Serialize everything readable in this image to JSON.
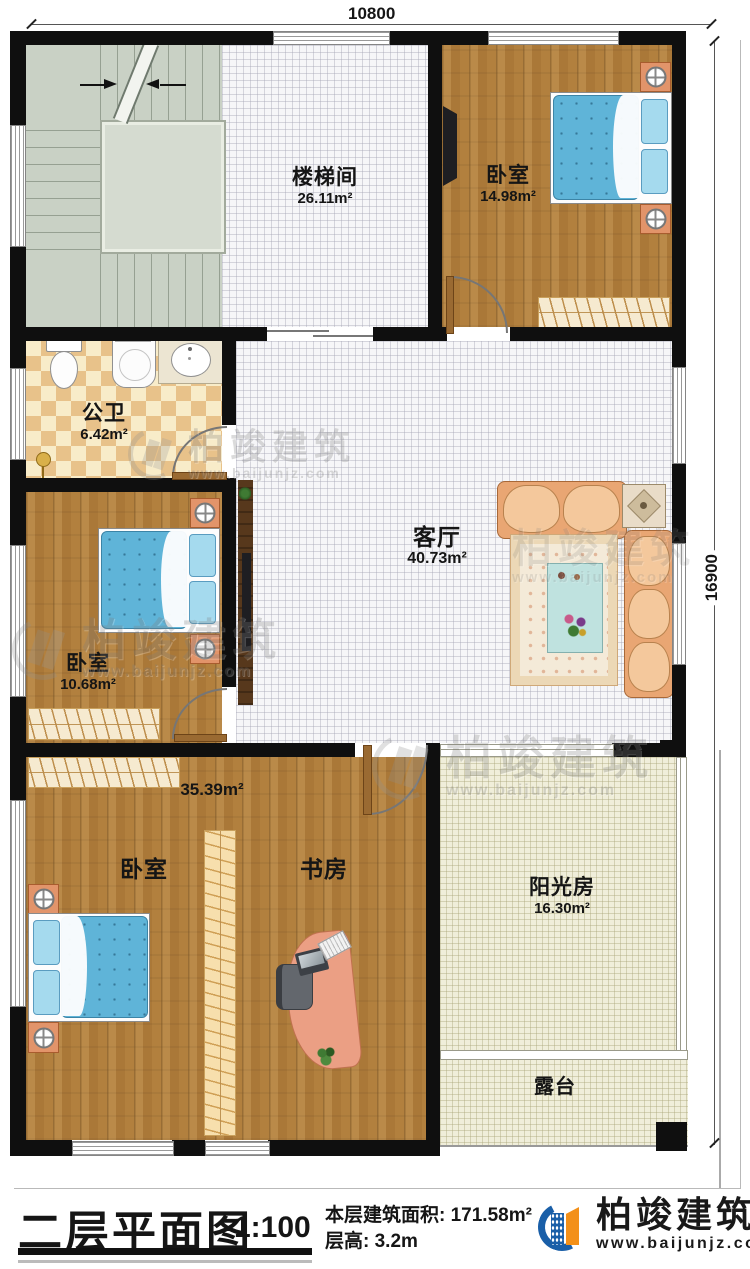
{
  "page": {
    "dimensions": {
      "top": "10800",
      "right": "16900"
    }
  },
  "watermark": {
    "brand": "柏竣建筑",
    "site": "www.baijunjz.com"
  },
  "rooms": {
    "stairwell": {
      "label": "楼梯间",
      "area": "26.11m²"
    },
    "bedroom_top_right": {
      "label": "卧室",
      "area": "14.98m²"
    },
    "bathroom": {
      "label": "公卫",
      "area": "6.42m²"
    },
    "living": {
      "label": "客厅",
      "area": "40.73m²"
    },
    "bedroom_left": {
      "label": "卧室",
      "area": "10.68m²"
    },
    "suite": {
      "area": "35.39m²",
      "bedroom": "卧室",
      "study": "书房"
    },
    "sunroom": {
      "label": "阳光房",
      "area": "16.30m²"
    },
    "terrace": {
      "label": "露台"
    }
  },
  "title_block": {
    "title": "二层平面图",
    "scale": "1:100",
    "area_line": "本层建筑面积: 171.58m²",
    "height_line": "层高: 3.2m",
    "brand": "柏竣建筑",
    "site": "www.baijunjz.com"
  },
  "colors": {
    "wall": "#0f0f0f",
    "wood_floor": "#b2803e",
    "tile_floor": "#f6f6f8",
    "bath_tile": "#e8c28a",
    "sunroom_floor": "#f0eeda",
    "stair_floor": "#c9d1c5",
    "mattress_blue": "#5fb4d8",
    "sofa_orange": "#e9a673",
    "brand_blue": "#1a5fa8",
    "brand_orange": "#f39019"
  }
}
